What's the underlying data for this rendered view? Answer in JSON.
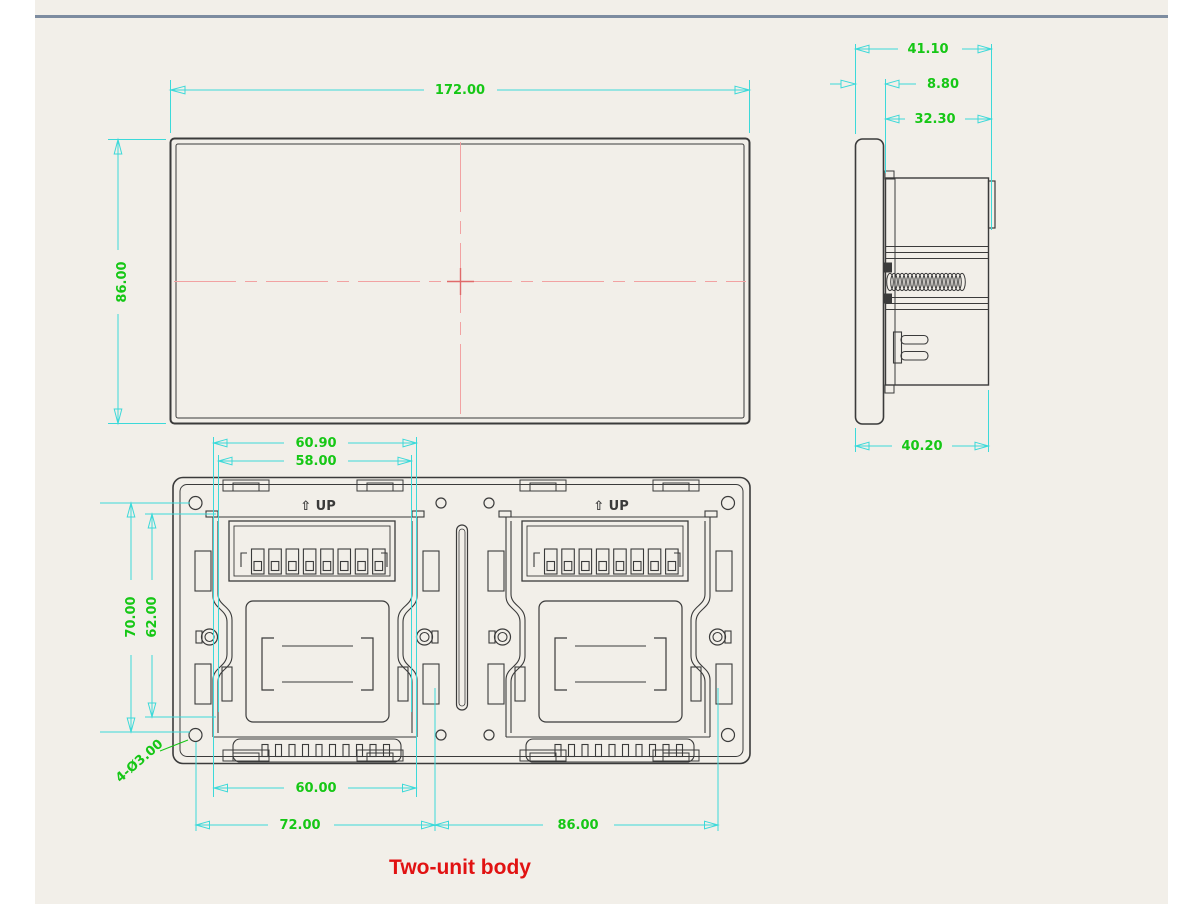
{
  "title": {
    "label": "Two-unit body"
  },
  "front_view": {
    "width_dim": "172.00",
    "height_dim": "86.00"
  },
  "side_view": {
    "total_depth_dim": "41.10",
    "flange_thickness_dim": "8.80",
    "body_depth_dim": "32.30",
    "mount_depth_dim": "40.20"
  },
  "back_view": {
    "up_label": "⇧ UP",
    "bracket_width_dim": "60.90",
    "bracket_inner_width_dim": "58.00",
    "screw_hole_spacing_dim": "70.00",
    "bracket_height_dim": "62.00",
    "module_width_dim": "60.00",
    "left_span_dim": "72.00",
    "right_span_dim": "86.00",
    "hole_callout": "4-Ø3.00"
  },
  "colors": {
    "canvas": "#f2efe9",
    "divider": "#7d8ca0",
    "drawing_line": "#3b3b3b",
    "dimension_line": "#3cd9d9",
    "dimension_text": "#16c716",
    "centerline": "#f2a2a2",
    "title": "#e11212"
  }
}
